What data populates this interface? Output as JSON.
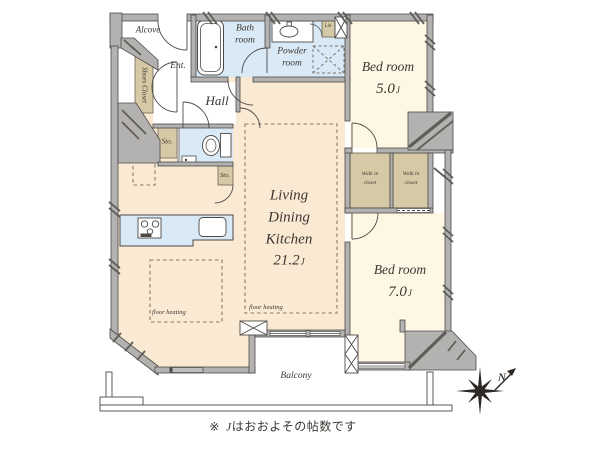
{
  "colors": {
    "wall_fill": "#b4b2b0",
    "wall_edge": "#4c4a47",
    "ldk_floor": "#fae9d3",
    "bedroom_floor": "#fdf7e4",
    "wet_room": "#d9eaf6",
    "closet": "#d6c9a6",
    "dashed_line": "#8a7c66",
    "text": "#3b3733"
  },
  "icons": {
    "bathtub": "bathtub-icon",
    "vanity_sink": "vanity-sink-icon",
    "washing_machine_space": "washing-machine-space-icon",
    "toilet": "toilet-icon",
    "stove": "stove-icon",
    "kitchen_sink": "kitchen-sink-icon",
    "pipe_shaft": "pipe-shaft-x-icon",
    "compass": "compass-rose-icon"
  },
  "rooms": {
    "alcove": {
      "label": "Alcove"
    },
    "entrance": {
      "label": "Ent."
    },
    "shoes_closet": {
      "label": "Shoes Closet"
    },
    "bath": {
      "label": "Bath\nroom"
    },
    "powder": {
      "label": "Powder\nroom"
    },
    "linen": {
      "label": "Lin"
    },
    "hall": {
      "label": "Hall"
    },
    "storage_hall": {
      "label": "Sto."
    },
    "storage_ldk": {
      "label": "Sto."
    },
    "bedroom_5": {
      "label": "Bed room",
      "size_value": "5.0",
      "size_unit": "J"
    },
    "walk_in_closet_1": {
      "label": "Walk in\ncloset"
    },
    "walk_in_closet_2": {
      "label": "Walk in\ncloset"
    },
    "ldk": {
      "label": "Living\nDining\nKitchen",
      "size_value": "21.2",
      "size_unit": "J"
    },
    "bedroom_7": {
      "label": "Bed room",
      "size_value": "7.0",
      "size_unit": "J"
    },
    "balcony": {
      "label": "Balcony"
    },
    "floor_heating_left": {
      "label": "floor heating"
    },
    "floor_heating_center": {
      "label": "floor heating"
    }
  },
  "compass": {
    "north_label": "N"
  },
  "footnote": {
    "symbol": "※",
    "unit": "J",
    "text": "はおおよその帖数です"
  }
}
